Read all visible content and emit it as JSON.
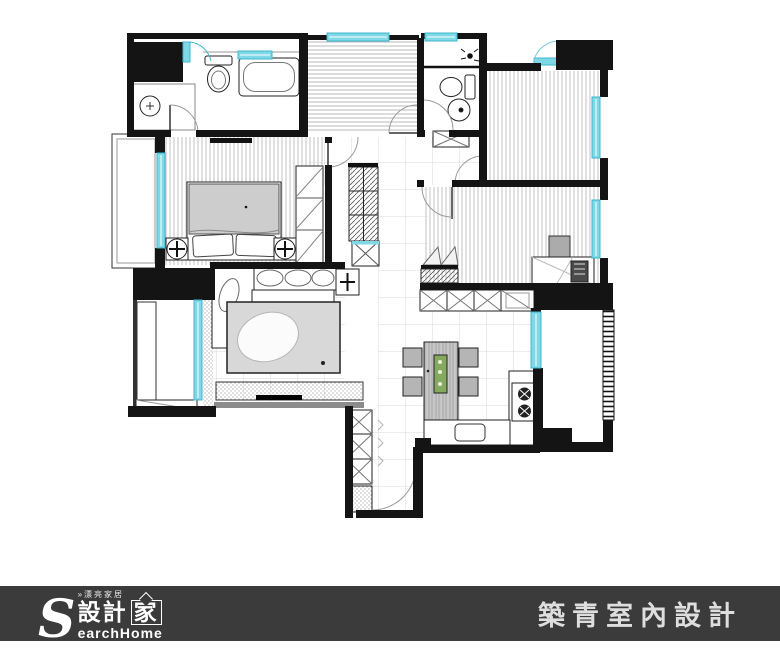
{
  "footer": {
    "logo": {
      "s": "S",
      "tagline": "»漂亮家居",
      "brand_zh_left": "設計",
      "brand_zh_house": "家",
      "brand_en_rest": "earchHome"
    },
    "company": "築青室內設計"
  },
  "colors": {
    "wall": "#141414",
    "window": "#7fd8e6",
    "window_stroke": "#3fb6cc",
    "runner_green": "#86a960",
    "footer_bg": "#3b3b3b",
    "footer_text": "#dedede",
    "rug": "#d8d8d8",
    "duvet": "#cdcdcd"
  }
}
